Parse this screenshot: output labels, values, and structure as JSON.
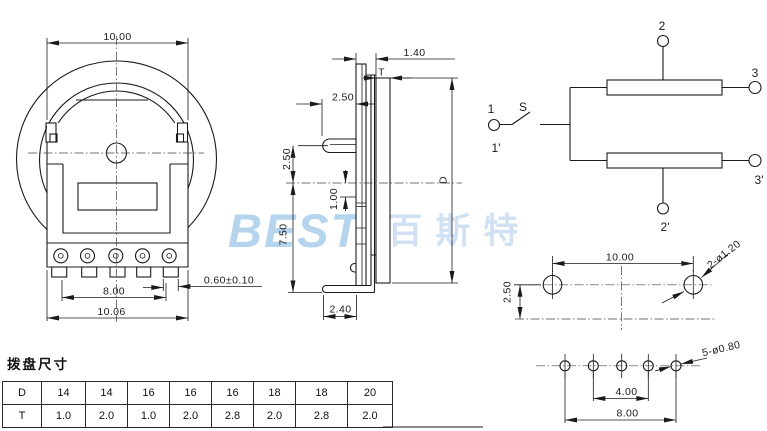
{
  "watermark": {
    "latin": "BEST",
    "cjk": "百斯特"
  },
  "front_view": {
    "dim_top_width": "10.00",
    "dim_pin_span": "8.00",
    "dim_body_width": "10.06",
    "dim_pin_thickness": "0.60±0.10"
  },
  "side_view": {
    "dim_protrusion": "1.40",
    "thickness_label": "T",
    "dim_hub_protrusion": "2.50",
    "dim_hub_offset": "2.50",
    "dim_wiper_offset": "1.00",
    "dim_below_center": "7.50",
    "diameter_label": "D",
    "dim_foot_depth": "2.40"
  },
  "schematic": {
    "terminal_1": "1",
    "terminal_1p": "1'",
    "switch_label": "S",
    "terminal_2": "2",
    "terminal_3": "3",
    "terminal_3p": "3'",
    "terminal_2p": "2'"
  },
  "pcb_top": {
    "dim_hole_span": "10.00",
    "dim_row_offset": "2.50",
    "hole_spec": "2-ø1.20"
  },
  "pcb_bottom": {
    "hole_spec": "5-ø0.80",
    "dim_pitch": "4.00",
    "dim_span": "8.00"
  },
  "table": {
    "title": "拨盘尺寸",
    "rows": [
      {
        "label": "D",
        "values": [
          "14",
          "14",
          "16",
          "16",
          "16",
          "18",
          "18",
          "20"
        ]
      },
      {
        "label": "T",
        "values": [
          "1.0",
          "2.0",
          "1.0",
          "2.0",
          "2.8",
          "2.0",
          "2.8",
          "2.0"
        ]
      }
    ]
  }
}
